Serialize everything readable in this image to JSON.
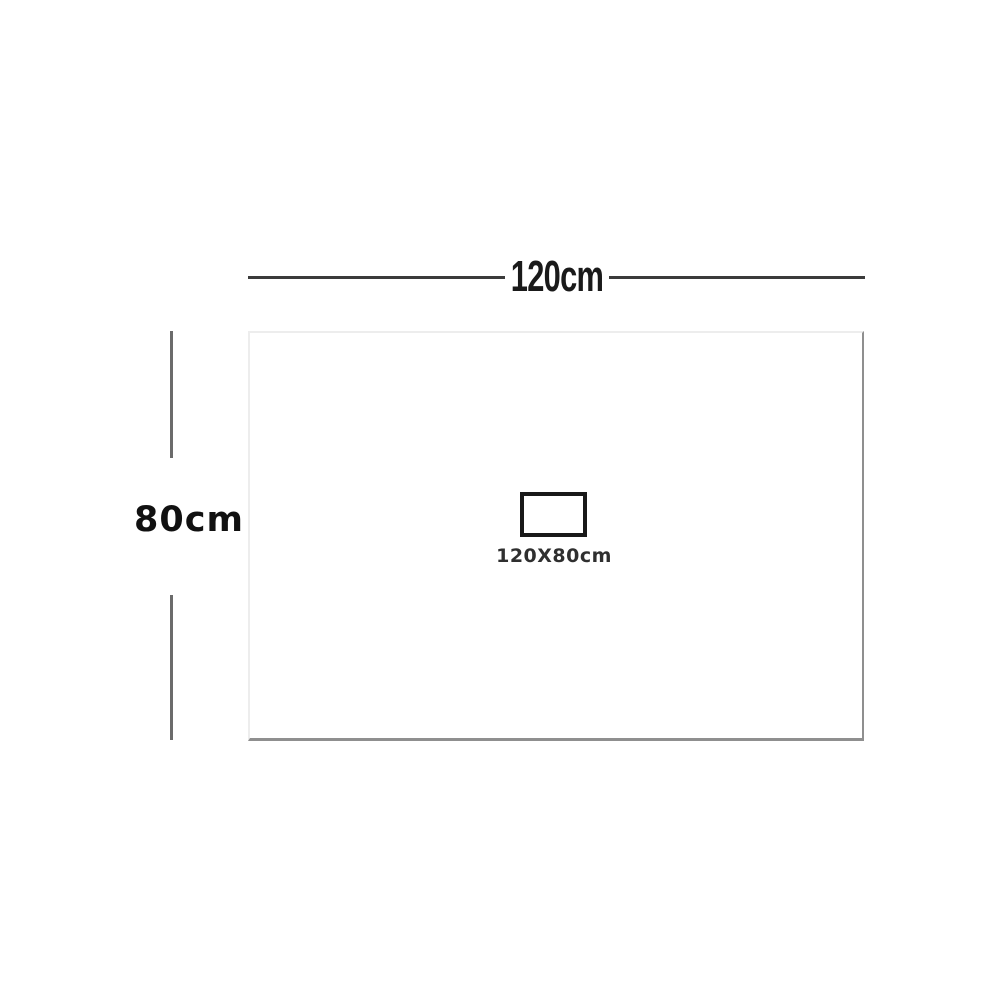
{
  "diagram": {
    "width_label": "120cm",
    "height_label": "80cm",
    "inner_label": "120X80cm",
    "colors": {
      "background": "#ffffff",
      "horizontal_line": "#3b3b3b",
      "vertical_line": "#6b6b6b",
      "board_border_light": "#ededed",
      "board_border_shadow": "#8f8f8f",
      "inner_rect_border": "#191919",
      "width_label_color": "#1a1a1a",
      "height_label_color": "#111111",
      "inner_label_color": "#2f2f2f"
    }
  }
}
